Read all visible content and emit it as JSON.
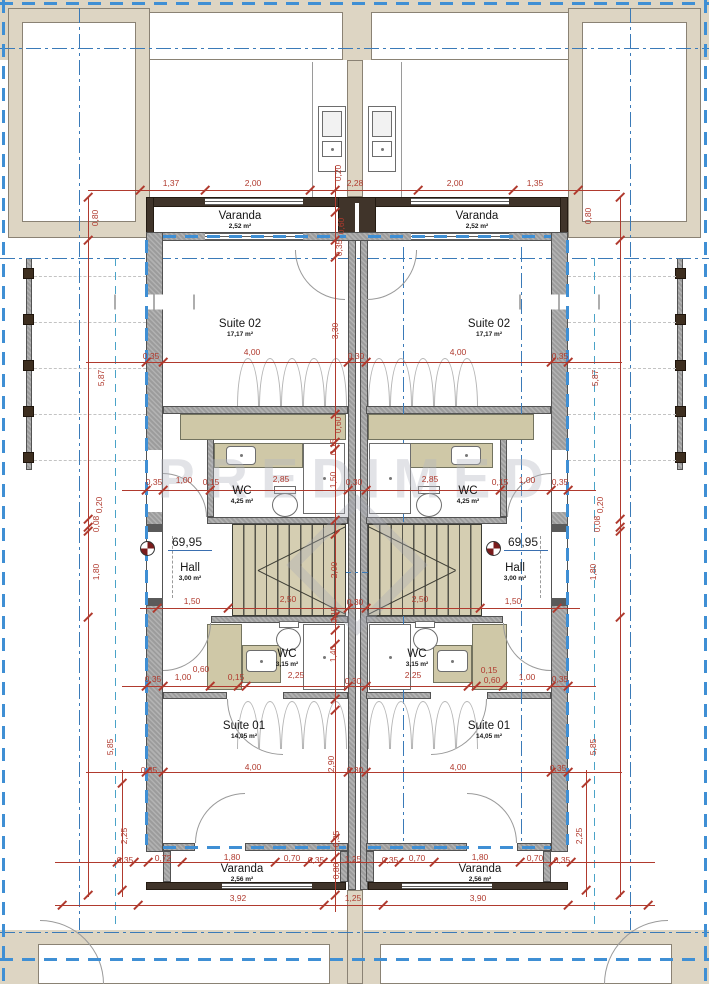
{
  "watermark": {
    "text": "PREDIMED"
  },
  "rooms": {
    "varanda_tl": {
      "name": "Varanda",
      "area": "2,52 m²"
    },
    "varanda_tr": {
      "name": "Varanda",
      "area": "2,52 m²"
    },
    "suite02_l": {
      "name": "Suite 02",
      "area": "17,17 m²"
    },
    "suite02_r": {
      "name": "Suite 02",
      "area": "17,17 m²"
    },
    "wc_up_l": {
      "name": "WC",
      "area": "4,25 m²"
    },
    "wc_up_r": {
      "name": "WC",
      "area": "4,25 m²"
    },
    "hall_l": {
      "name": "Hall",
      "area": "3,00 m²"
    },
    "hall_r": {
      "name": "Hall",
      "area": "3,00 m²"
    },
    "wc_lo_l": {
      "name": "WC",
      "area": "3,15 m²"
    },
    "wc_lo_r": {
      "name": "WC",
      "area": "3,15 m²"
    },
    "suite01_l": {
      "name": "Suite 01",
      "area": "14,05 m²"
    },
    "suite01_r": {
      "name": "Suite 01",
      "area": "14,05 m²"
    },
    "varanda_bl": {
      "name": "Varanda",
      "area": "2,56 m²"
    },
    "varanda_br": {
      "name": "Varanda",
      "area": "2,56 m²"
    }
  },
  "levels": {
    "left": "69,95",
    "right": "69,95"
  },
  "colors": {
    "dimension": "#b03a2e",
    "axis_blue": "#3a7ab8",
    "boundary_blue": "#3f8fd4",
    "wall_gray": "#9c9c9c",
    "balcony_brown": "#40342a",
    "furniture_tan": "#cfc8a7"
  },
  "dim_chains": [
    {
      "o": "h",
      "p": 190,
      "a": 88,
      "b": 620,
      "t": [
        140,
        205,
        310,
        418,
        513,
        578
      ]
    },
    {
      "o": "h",
      "p": 362,
      "a": 86,
      "b": 622,
      "t": [
        146,
        163,
        348,
        366,
        551,
        568
      ]
    },
    {
      "o": "h",
      "p": 490,
      "a": 122,
      "b": 596,
      "t": [
        146,
        163,
        210,
        348,
        366,
        500,
        551,
        568
      ]
    },
    {
      "o": "h",
      "p": 608,
      "a": 140,
      "b": 580,
      "t": [
        157,
        228,
        348,
        366,
        480,
        557
      ]
    },
    {
      "o": "h",
      "p": 686,
      "a": 122,
      "b": 596,
      "t": [
        146,
        163,
        210,
        238,
        246,
        348,
        366,
        468,
        476,
        503,
        551,
        568
      ]
    },
    {
      "o": "h",
      "p": 772,
      "a": 86,
      "b": 622,
      "t": [
        146,
        163,
        348,
        366,
        551,
        568
      ]
    },
    {
      "o": "h",
      "p": 862,
      "a": 55,
      "b": 655,
      "t": [
        117,
        134,
        148,
        182,
        275,
        308,
        323,
        383,
        399,
        434,
        520,
        553,
        571
      ]
    },
    {
      "o": "h",
      "p": 905,
      "a": 55,
      "b": 655,
      "t": [
        62,
        138,
        324,
        383,
        568,
        648
      ]
    },
    {
      "o": "v",
      "p": 88,
      "a": 197,
      "b": 897,
      "t": [
        197,
        240,
        519,
        527,
        531,
        617,
        895
      ]
    },
    {
      "o": "v",
      "p": 122,
      "a": 770,
      "b": 897,
      "t": [
        783,
        890
      ]
    },
    {
      "o": "v",
      "p": 620,
      "a": 197,
      "b": 897,
      "t": [
        197,
        240,
        519,
        527,
        531,
        617,
        895
      ]
    },
    {
      "o": "v",
      "p": 586,
      "a": 770,
      "b": 897,
      "t": [
        783,
        890
      ]
    },
    {
      "o": "v",
      "p": 335,
      "a": 166,
      "b": 912,
      "t": [
        190,
        212,
        240,
        257,
        414,
        442,
        449,
        520,
        534,
        616,
        630,
        644,
        699,
        710,
        838,
        857,
        895
      ]
    }
  ],
  "dim_labels": [
    {
      "t": "1,37",
      "x": 171,
      "y": 183
    },
    {
      "t": "2,00",
      "x": 253,
      "y": 183
    },
    {
      "t": "2,28",
      "x": 355,
      "y": 183
    },
    {
      "t": "2,00",
      "x": 455,
      "y": 183
    },
    {
      "t": "1,35",
      "x": 535,
      "y": 183
    },
    {
      "t": "0,20",
      "x": 338,
      "y": 173,
      "r": 1
    },
    {
      "t": "0,60",
      "x": 341,
      "y": 226,
      "r": 1
    },
    {
      "t": "0,35",
      "x": 339,
      "y": 248,
      "r": 1
    },
    {
      "t": "0,80",
      "x": 95,
      "y": 218,
      "r": 1
    },
    {
      "t": "5,87",
      "x": 101,
      "y": 378,
      "r": 1
    },
    {
      "t": "0,20",
      "x": 99,
      "y": 505,
      "r": 1
    },
    {
      "t": "0,08",
      "x": 96,
      "y": 524,
      "r": 1
    },
    {
      "t": "1,80",
      "x": 96,
      "y": 572,
      "r": 1
    },
    {
      "t": "5,85",
      "x": 110,
      "y": 747,
      "r": 1
    },
    {
      "t": "2,25",
      "x": 124,
      "y": 836,
      "r": 1
    },
    {
      "t": "0,80",
      "x": 588,
      "y": 216,
      "r": 1
    },
    {
      "t": "5,87",
      "x": 595,
      "y": 378,
      "r": 1
    },
    {
      "t": "0,20",
      "x": 600,
      "y": 505,
      "r": 1
    },
    {
      "t": "0,08",
      "x": 597,
      "y": 524,
      "r": 1
    },
    {
      "t": "1,80",
      "x": 593,
      "y": 572,
      "r": 1
    },
    {
      "t": "5,85",
      "x": 593,
      "y": 747,
      "r": 1
    },
    {
      "t": "2,25",
      "x": 579,
      "y": 836,
      "r": 1
    },
    {
      "t": "0,35",
      "x": 151,
      "y": 356
    },
    {
      "t": "4,00",
      "x": 252,
      "y": 352
    },
    {
      "t": "0,30",
      "x": 356,
      "y": 356
    },
    {
      "t": "4,00",
      "x": 458,
      "y": 352
    },
    {
      "t": "0,35",
      "x": 560,
      "y": 356
    },
    {
      "t": "3,30",
      "x": 335,
      "y": 331,
      "r": 1
    },
    {
      "t": "0,35",
      "x": 154,
      "y": 482
    },
    {
      "t": "1,00",
      "x": 184,
      "y": 480
    },
    {
      "t": "0,15",
      "x": 211,
      "y": 482
    },
    {
      "t": "2,85",
      "x": 281,
      "y": 479
    },
    {
      "t": "0,30",
      "x": 354,
      "y": 482
    },
    {
      "t": "2,85",
      "x": 430,
      "y": 479
    },
    {
      "t": "0,15",
      "x": 500,
      "y": 482
    },
    {
      "t": "1,00",
      "x": 527,
      "y": 480
    },
    {
      "t": "0,35",
      "x": 560,
      "y": 482
    },
    {
      "t": "0,60",
      "x": 338,
      "y": 425,
      "r": 1
    },
    {
      "t": "0,15",
      "x": 333,
      "y": 447,
      "r": 1
    },
    {
      "t": "1,50",
      "x": 333,
      "y": 480,
      "r": 1
    },
    {
      "t": "1,50",
      "x": 192,
      "y": 601
    },
    {
      "t": "2,50",
      "x": 288,
      "y": 599
    },
    {
      "t": "0,30",
      "x": 355,
      "y": 602
    },
    {
      "t": "2,50",
      "x": 420,
      "y": 599
    },
    {
      "t": "1,50",
      "x": 513,
      "y": 601
    },
    {
      "t": "2,00",
      "x": 334,
      "y": 570,
      "r": 1
    },
    {
      "t": "0,15",
      "x": 334,
      "y": 615,
      "r": 1
    },
    {
      "t": "0,35",
      "x": 153,
      "y": 679
    },
    {
      "t": "1,00",
      "x": 183,
      "y": 677
    },
    {
      "t": "0,60",
      "x": 201,
      "y": 669
    },
    {
      "t": "0,15",
      "x": 236,
      "y": 677
    },
    {
      "t": "2,25",
      "x": 296,
      "y": 675
    },
    {
      "t": "0,30",
      "x": 353,
      "y": 681
    },
    {
      "t": "2,25",
      "x": 413,
      "y": 675
    },
    {
      "t": "0,15",
      "x": 489,
      "y": 670
    },
    {
      "t": "0,60",
      "x": 492,
      "y": 680
    },
    {
      "t": "1,00",
      "x": 527,
      "y": 677
    },
    {
      "t": "0,35",
      "x": 560,
      "y": 679
    },
    {
      "t": "1,40",
      "x": 333,
      "y": 654,
      "r": 1
    },
    {
      "t": "0,35",
      "x": 149,
      "y": 770
    },
    {
      "t": "4,00",
      "x": 253,
      "y": 767
    },
    {
      "t": "0,30",
      "x": 355,
      "y": 770
    },
    {
      "t": "4,00",
      "x": 458,
      "y": 767
    },
    {
      "t": "0,35",
      "x": 558,
      "y": 768
    },
    {
      "t": "2,90",
      "x": 331,
      "y": 764,
      "r": 1
    },
    {
      "t": "0,35",
      "x": 336,
      "y": 839,
      "r": 1
    },
    {
      "t": "0,80",
      "x": 336,
      "y": 871,
      "r": 1
    },
    {
      "t": "0,35",
      "x": 125,
      "y": 860
    },
    {
      "t": "0,72",
      "x": 163,
      "y": 858
    },
    {
      "t": "1,80",
      "x": 232,
      "y": 857
    },
    {
      "t": "0,70",
      "x": 292,
      "y": 858
    },
    {
      "t": "0,35",
      "x": 316,
      "y": 860
    },
    {
      "t": "1,25",
      "x": 353,
      "y": 859
    },
    {
      "t": "0,35",
      "x": 390,
      "y": 860
    },
    {
      "t": "0,70",
      "x": 417,
      "y": 858
    },
    {
      "t": "1,80",
      "x": 480,
      "y": 857
    },
    {
      "t": "0,70",
      "x": 535,
      "y": 858
    },
    {
      "t": "0,35",
      "x": 562,
      "y": 860
    },
    {
      "t": "3,92",
      "x": 238,
      "y": 898
    },
    {
      "t": "1,25",
      "x": 353,
      "y": 898
    },
    {
      "t": "3,90",
      "x": 478,
      "y": 898
    }
  ]
}
